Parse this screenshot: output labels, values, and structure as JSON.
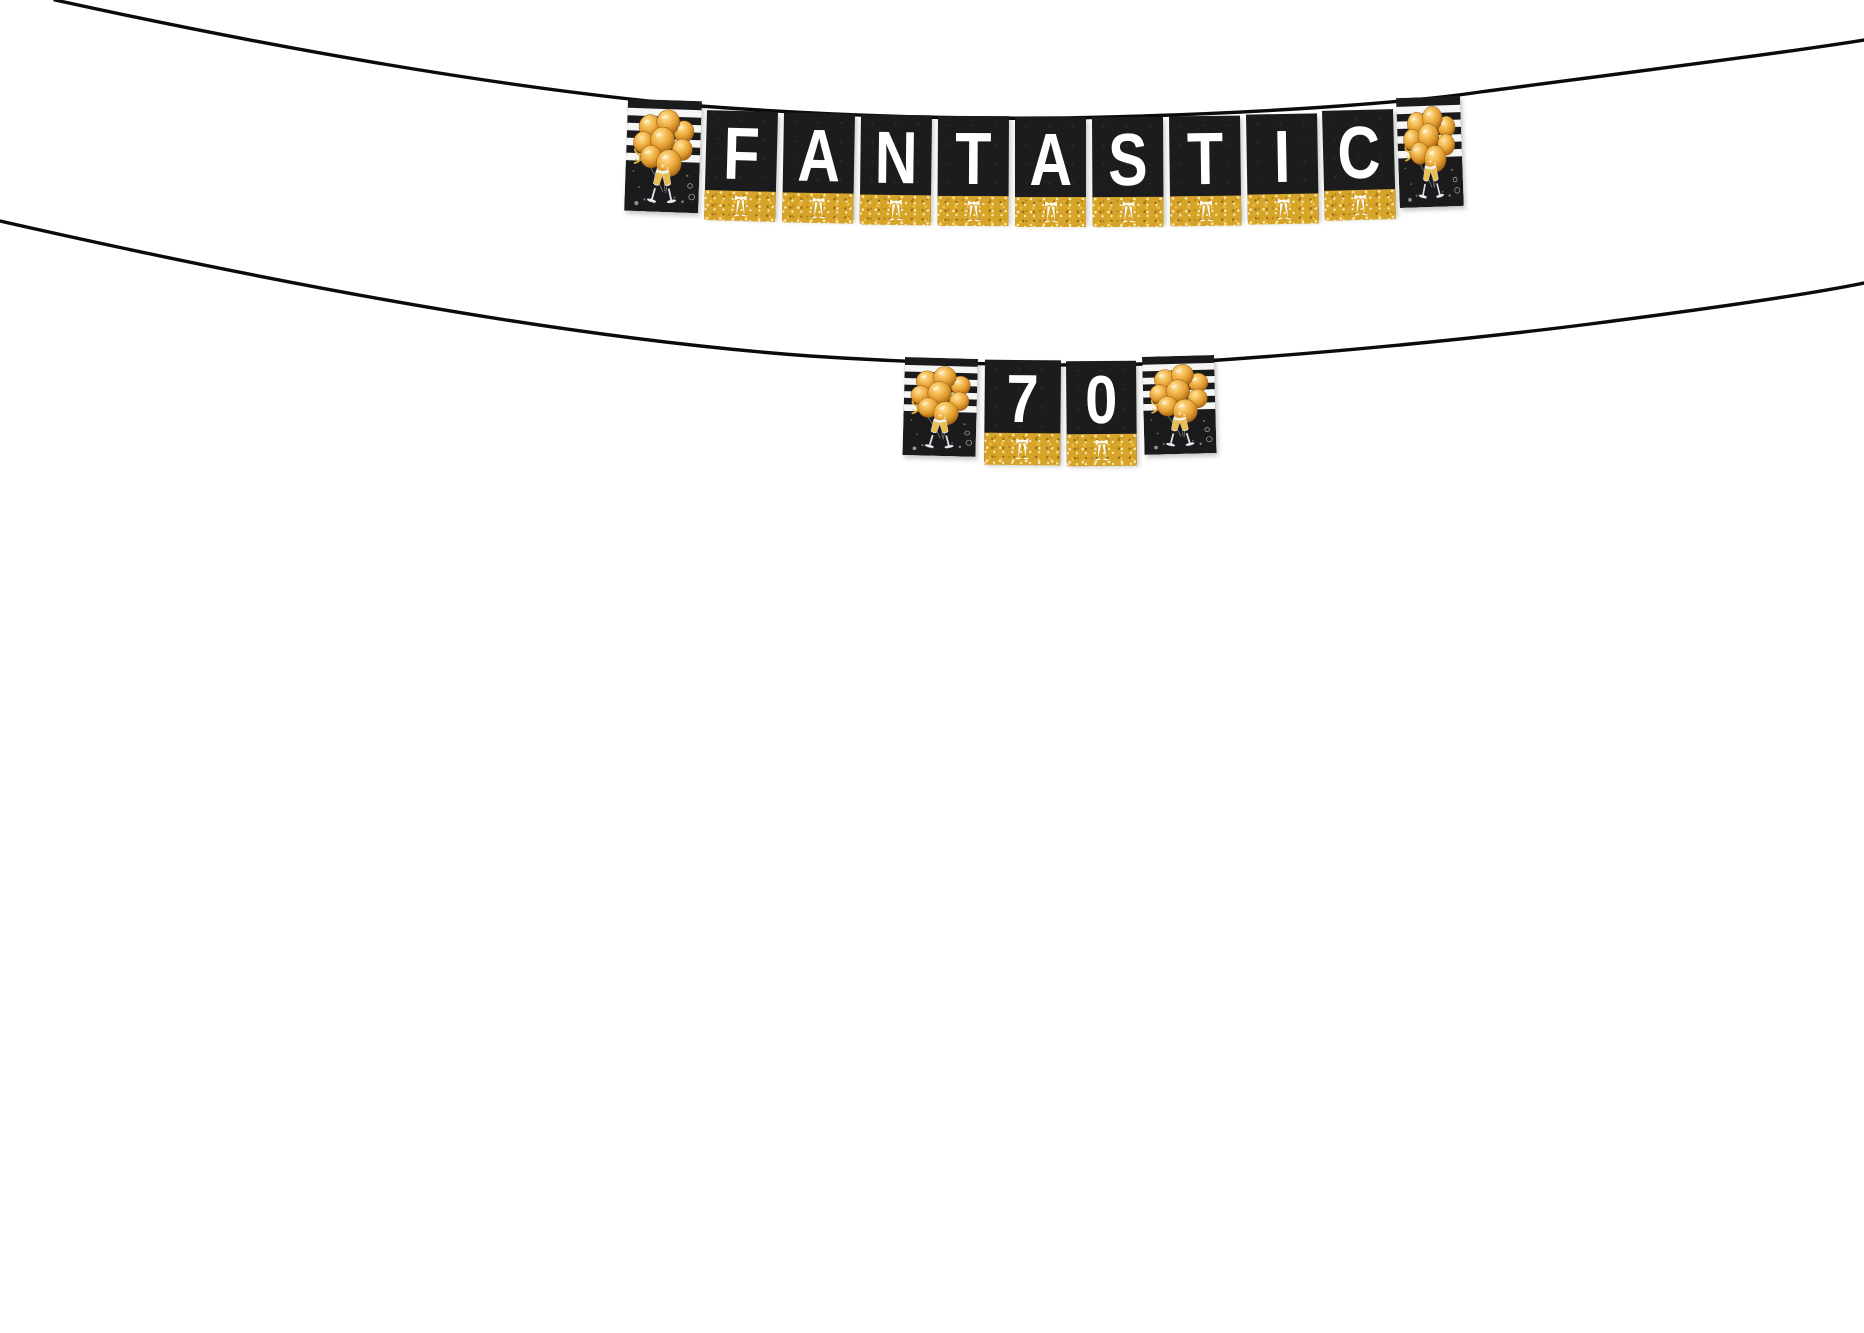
{
  "scene": {
    "description": "Black and gold party pennant banner strung on two cords over a white background",
    "background_color": "#ffffff"
  },
  "banner_top": {
    "word": "FANTASTIC",
    "letters": [
      "F",
      "A",
      "N",
      "T",
      "A",
      "S",
      "T",
      "I",
      "C"
    ]
  },
  "banner_bottom": {
    "word": "70",
    "letters": [
      "7",
      "0"
    ]
  },
  "colors": {
    "string_black": "#0b0b0b",
    "pennant_black": "#1c1c1e",
    "stripe_white": "#f6f6f4",
    "glitter_gold": "#D7A42A",
    "balloon_gold": "#E29B2D",
    "letter_white": "#ffffff"
  }
}
